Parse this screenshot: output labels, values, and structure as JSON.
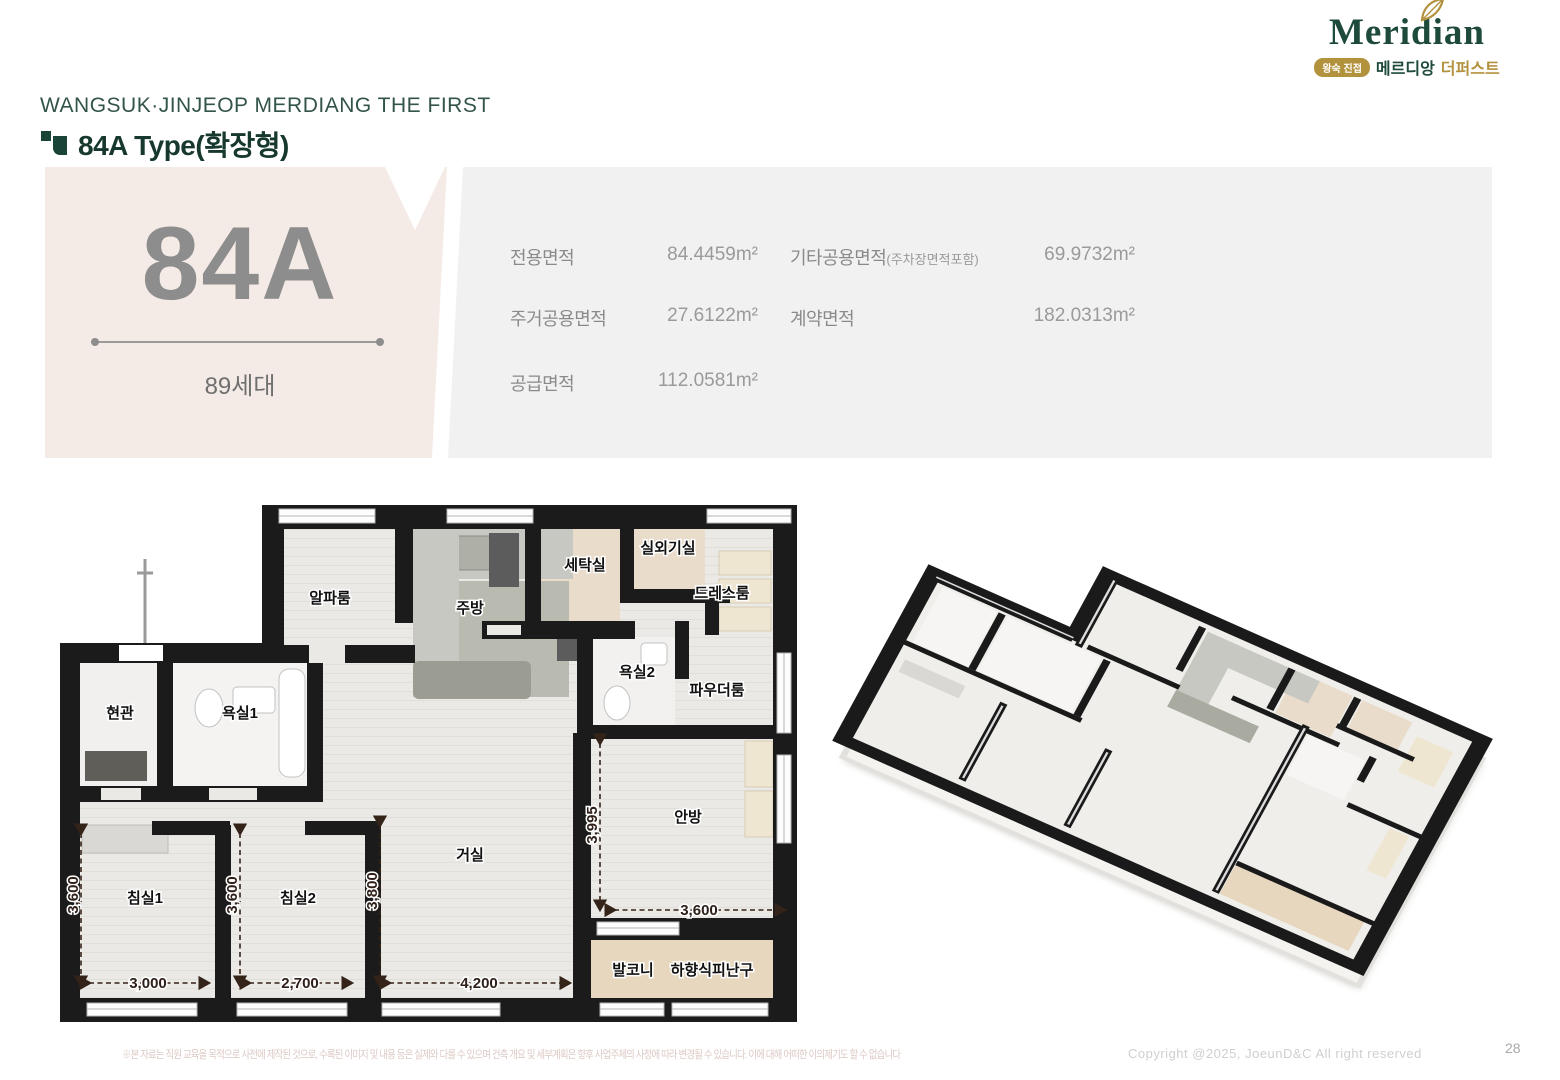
{
  "header": {
    "project_title": "WANGSUK·JINJEOP MERDIANG THE FIRST",
    "unit_title": "84A Type(확장형)"
  },
  "logo": {
    "brand": "Meridian",
    "badge": "왕숙 진접",
    "sub_brand": "메르디앙",
    "sub_brand2": "더퍼스트"
  },
  "unit_card": {
    "type_code": "84A",
    "households": "89세대",
    "bg_color": "#f5ebe6"
  },
  "area_table": {
    "col1": [
      {
        "label": "전용면적",
        "value": "84.4459m²"
      },
      {
        "label": "주거공용면적",
        "value": "27.6122m²"
      },
      {
        "label": "공급면적",
        "value": "112.0581m²"
      }
    ],
    "col2": [
      {
        "label": "기타공용면적",
        "sublabel": "(주차장면적포함)",
        "value": "69.9732m²"
      },
      {
        "label": "계약면적",
        "sublabel": "",
        "value": "182.0313m²"
      }
    ]
  },
  "floor_plan": {
    "rooms": [
      {
        "id": "entrance",
        "label": "현관"
      },
      {
        "id": "bath1",
        "label": "욕실1"
      },
      {
        "id": "alpha-room",
        "label": "알파룸"
      },
      {
        "id": "kitchen",
        "label": "주방"
      },
      {
        "id": "laundry",
        "label": "세탁실"
      },
      {
        "id": "outdoor-unit-room",
        "label": "실외기실"
      },
      {
        "id": "dress-room",
        "label": "드레스룸"
      },
      {
        "id": "bath2",
        "label": "욕실2"
      },
      {
        "id": "powder-room",
        "label": "파우더룸"
      },
      {
        "id": "living-room",
        "label": "거실"
      },
      {
        "id": "master-bedroom",
        "label": "안방"
      },
      {
        "id": "bedroom1",
        "label": "침실1"
      },
      {
        "id": "bedroom2",
        "label": "침실2"
      },
      {
        "id": "balcony",
        "label": "발코니"
      },
      {
        "id": "escape-hatch",
        "label": "하향식피난구"
      }
    ],
    "dimensions": [
      {
        "id": "bedroom1-depth",
        "value": "3,600"
      },
      {
        "id": "bedroom1-width",
        "value": "3,000"
      },
      {
        "id": "bedroom2-depth",
        "value": "3,600"
      },
      {
        "id": "bedroom2-width",
        "value": "2,700"
      },
      {
        "id": "living-depth",
        "value": "3,800"
      },
      {
        "id": "living-width",
        "value": "4,200"
      },
      {
        "id": "master-depth",
        "value": "3,995"
      },
      {
        "id": "master-width",
        "value": "3,600"
      }
    ]
  },
  "footer": {
    "disclaimer": "※본 자료는 직원 교육을 목적으로 사전에 제작된 것으로, 수록된 이미지 및 내용 등은 실제와 다를 수 있으며 건축 개요 및 세부계획은 향후 사업주체의 사정에 따라 변경될 수 있습니다. 이에 대해 어떠한 이의제기도 할 수 없습니다",
    "copyright": "Copyright @2025, JoeunD&C All right reserved",
    "page_number": "28"
  }
}
